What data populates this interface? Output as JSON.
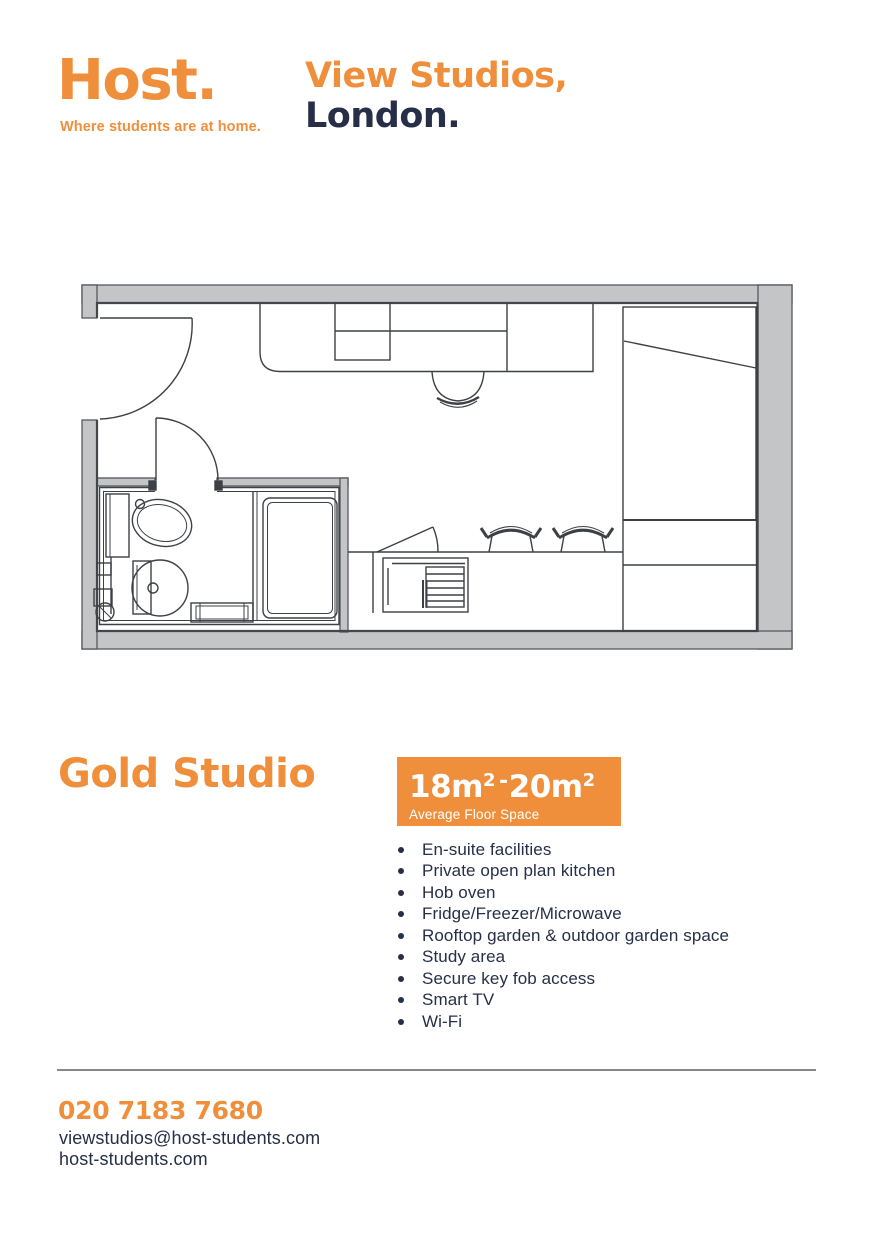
{
  "brand": {
    "logo_text": "Host.",
    "tagline": "Where students are at home."
  },
  "header": {
    "property_name": "View Studios,",
    "property_city": "London."
  },
  "colors": {
    "orange": "#EF8F3C",
    "navy": "#262E48",
    "wall_gray": "#C4C5C7",
    "line_gray": "#3D4045"
  },
  "floorplan": {
    "label": "Gold Studio floor plan",
    "rooms": [
      "en-suite bathroom",
      "open plan kitchen",
      "study area",
      "wardrobe"
    ]
  },
  "studio": {
    "title": "Gold Studio",
    "badge": {
      "min": "18m",
      "min_sup": "2",
      "sep": "-",
      "max": "20m",
      "max_sup": "2",
      "caption": "Average Floor Space"
    },
    "features": [
      "En-suite facilities",
      "Private open plan kitchen",
      "Hob oven",
      "Fridge/Freezer/Microwave",
      "Rooftop garden & outdoor garden space",
      "Study area",
      "Secure key fob access",
      "Smart TV",
      "Wi-Fi"
    ]
  },
  "footer": {
    "phone": "020 7183 7680",
    "email": "viewstudios@host-students.com",
    "website": "host-students.com"
  }
}
